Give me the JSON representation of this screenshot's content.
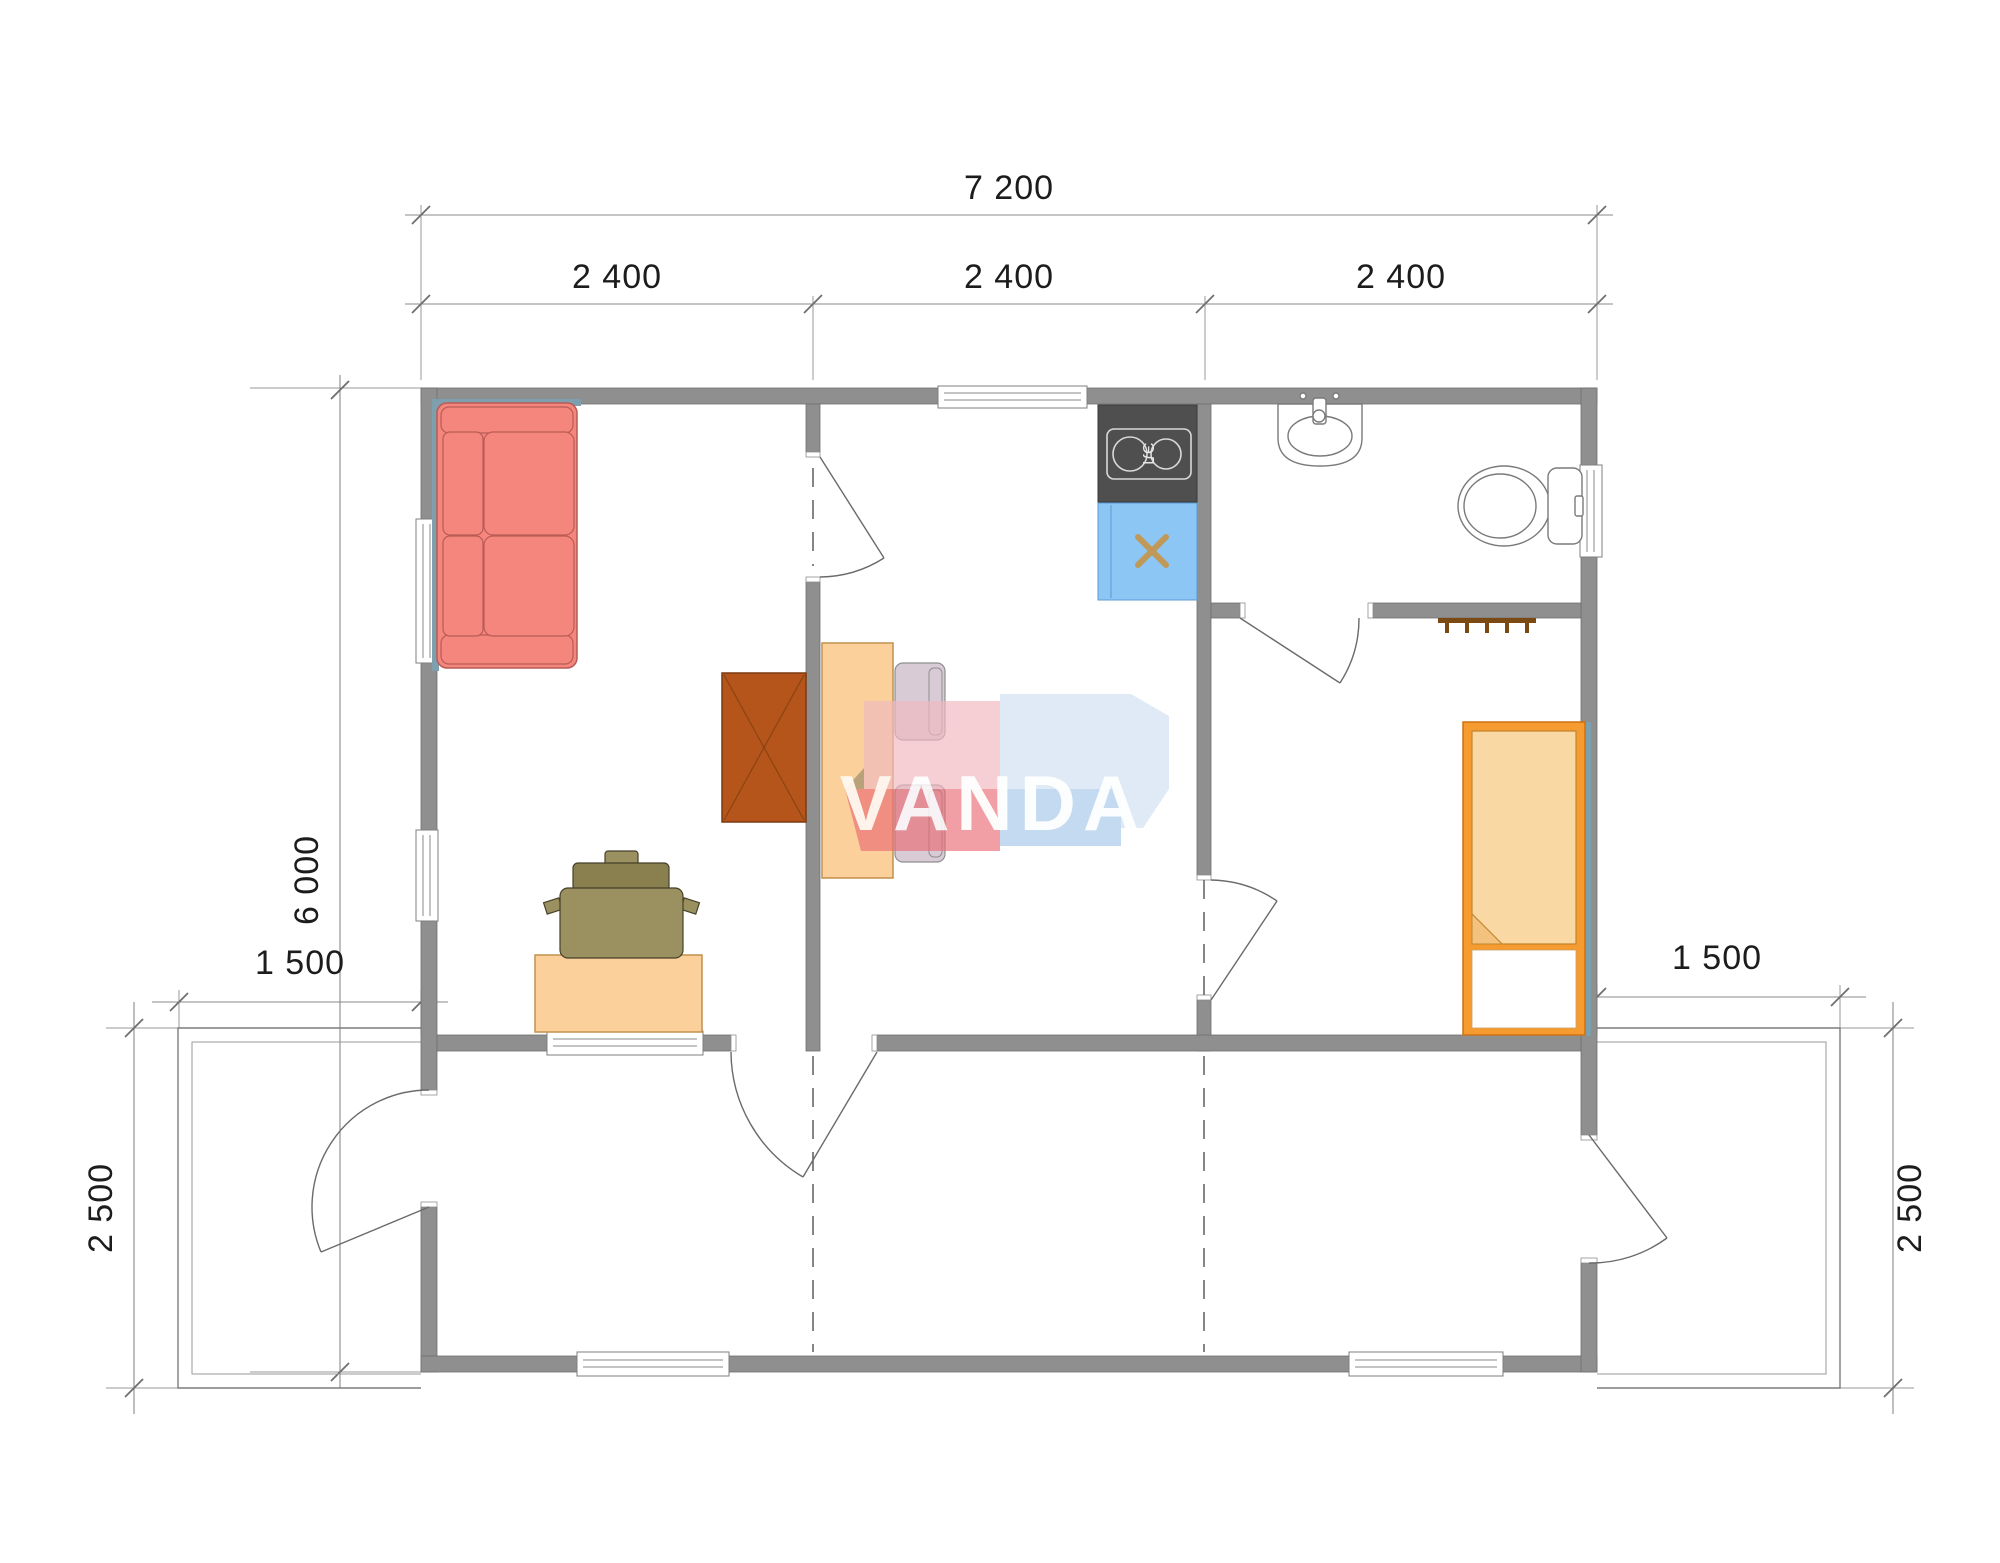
{
  "drawing": {
    "watermark": "VANDA",
    "stove_label": "ЭЛ"
  },
  "dimensions": {
    "total_width": "7 200",
    "module_width_1": "2 400",
    "module_width_2": "2 400",
    "module_width_3": "2 400",
    "total_depth": "6 000",
    "terrace_width_left": "1 500",
    "terrace_width_right": "1 500",
    "terrace_depth_left": "2 500",
    "terrace_depth_right": "2 500"
  },
  "colors": {
    "wall": "#8F8F8F",
    "sofa": "#F5867E",
    "wardrobe": "#B5551B",
    "table": "#FBD09A",
    "desk": "#FBD09A",
    "dining_chair": "#D8CBD6",
    "office_chair": "#9A9060",
    "office_chair_back": "#8A7F4E",
    "kitchen_counter": "#4F4F4F",
    "sink_unit": "#8CC6F5",
    "sink_x_mark": "#C09858",
    "bed_frame": "#F59B30",
    "bed_blanket": "#FAD8A4",
    "bed_fold": "#F3C27E",
    "hooks": "#7B4A12",
    "shadow": "#7E9FAE",
    "watermark_pink": "#F0B9C0",
    "watermark_red": "#EA6973",
    "watermark_blue_light": "#CFE0F2",
    "watermark_blue": "#A9C9EA",
    "watermark_fold": "#9B8D6A"
  }
}
